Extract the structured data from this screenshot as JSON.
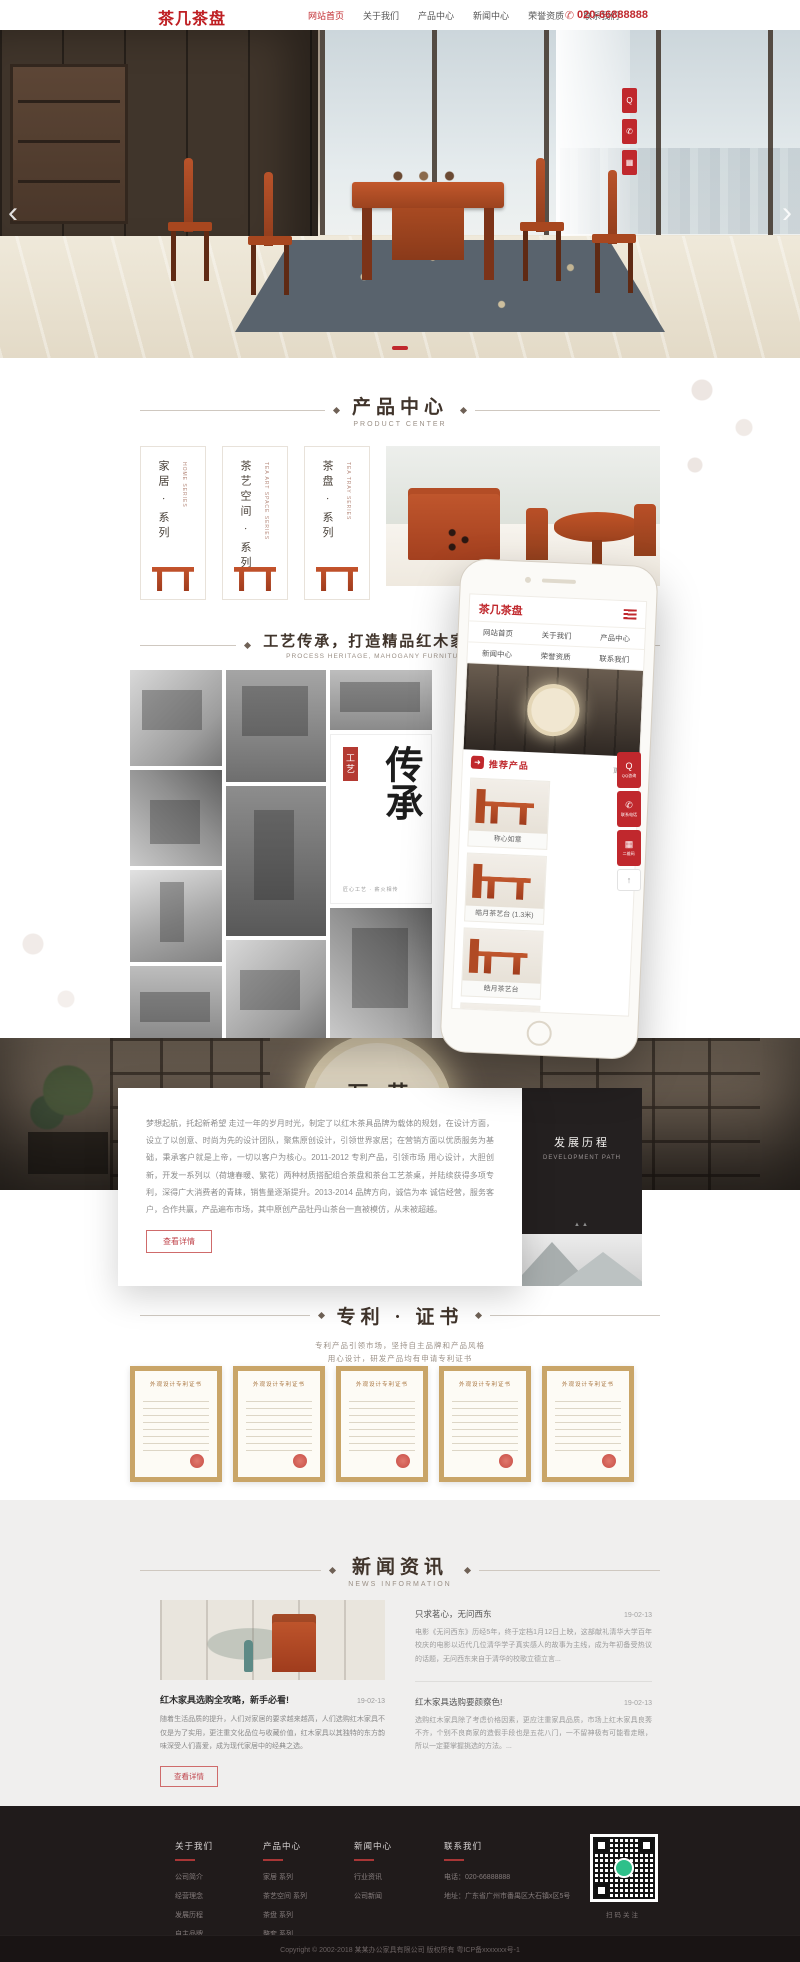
{
  "colors": {
    "accent": "#c0282d",
    "logo_red": "#bf1f23",
    "footer_bg": "#201b1b",
    "news_bg": "#f0efee",
    "title_brown": "#40342b"
  },
  "icons": {
    "prev": "‹",
    "next": "›",
    "phone": "✆",
    "hamburger": "≡",
    "arrow_badge": "➜",
    "qq": "Q",
    "tel": "✆",
    "qr": "▦",
    "up": "↑",
    "chat": "💬"
  },
  "header": {
    "logo": "茶几茶盘",
    "nav": [
      {
        "label": "网站首页"
      },
      {
        "label": "关于我们"
      },
      {
        "label": "产品中心"
      },
      {
        "label": "新闻中心"
      },
      {
        "label": "荣誉资质"
      },
      {
        "label": "联系我们"
      }
    ],
    "phone": "020-66888888"
  },
  "product_center": {
    "title": "产品中心",
    "subtitle": "PRODUCT CENTER",
    "categories": [
      {
        "name": "家居 · 系列",
        "en": "HOME SERIES"
      },
      {
        "name": "茶艺空间 · 系列",
        "en": "TEA ART SPACE SERIES"
      },
      {
        "name": "茶盘 · 系列",
        "en": "TEA TRAY SERIES"
      }
    ]
  },
  "craft": {
    "title": "工艺传承，打造精品红木家具 · 茶具",
    "subtitle": "PROCESS HERITAGE, MAHOGANY FURNITURE, TEA SETS",
    "badge": "工艺",
    "calligraphy": "传承",
    "caption": "匠心工艺 · 薪火相传"
  },
  "phone_mock": {
    "logo": "茶几茶盘",
    "menu": [
      "网站首页",
      "关于我们",
      "产品中心",
      "新闻中心",
      "荣誉资质",
      "联系我们"
    ],
    "section": "推荐产品",
    "more": "更多>",
    "products": [
      "称心如意",
      "皓月茶艺台 (1.3米)",
      "皓月茶艺台",
      "国色天香"
    ]
  },
  "showroom": {
    "sign_right": "艺造",
    "sign_left": "万家"
  },
  "about": {
    "text": "梦想起航，托起新希望 走过一年的岁月时光，制定了以红木茶具品牌为载体的规划，在设计方面，设立了以创意、时尚为先的设计团队，聚焦原创设计，引领世界家居；在营销方面以优质服务为基础，秉承客户就是上帝，一切以客户为核心。2011-2012 专利产品，引领市场 用心设计，大胆创新，开发一系列以（荷塘春暖、繁花）两种材质搭配组合茶盘和茶台工艺茶桌，并陆续获得多项专利，深得广大消费者的青睐，销售量逐渐提升。2013-2014 品牌方向，诚信为本 诚信经营，服务客户，合作共赢，产品遍布市场，其中原创产品牡丹山茶台一直被模仿，从未被超越。",
    "button": "查看详情",
    "panel_title": "发展历程",
    "panel_subtitle": "DEVELOPMENT PATH"
  },
  "patents": {
    "title": "专利 · 证书",
    "desc1": "专利产品引领市场，坚持自主品牌和产品风格",
    "desc2": "用心设计，研发产品均有申请专利证书",
    "cert_title": "外观设计专利证书"
  },
  "news": {
    "title": "新闻资讯",
    "subtitle": "NEWS INFORMATION",
    "featured": {
      "title": "红木家具选购全攻略，新手必看!",
      "date": "19-02-13",
      "text": "随着生活品质的提升，人们对家居的要求越来越高，人们选购红木家具不仅是为了实用，更注重文化品位与收藏价值，红木家具以其独特的东方韵味深受人们喜爱，成为现代家居中的经典之选。",
      "button": "查看详情"
    },
    "items": [
      {
        "title": "只求茗心，无问西东",
        "date": "19-02-13",
        "text": "电影《无问西东》历经5年，终于定档1月12日上映，这部献礼清华大学百年校庆的电影以近代几位清华学子真实感人的故事为主线，成为年初备受热议的话题，无问西东来自于清华的校歌立德立言..."
      },
      {
        "title": "红木家具选购要颜察色!",
        "date": "19-02-13",
        "text": "选购红木家具除了考虑价格因素，更应注重家具品质，市场上红木家具良莠不齐，个别不良商家的造假手段也是五花八门，一不留神极有可能看走眼，所以一定要掌握挑选的方法。..."
      }
    ]
  },
  "floating": [
    {
      "label": "QQ咨询"
    },
    {
      "label": "联系电话"
    },
    {
      "label": "二维码"
    },
    {
      "label": "返回顶部"
    }
  ],
  "footer": {
    "columns": [
      {
        "title": "关于我们",
        "links": [
          "公司简介",
          "经营理念",
          "发展历程",
          "自主品牌"
        ]
      },
      {
        "title": "产品中心",
        "links": [
          "家居 系列",
          "茶艺空间 系列",
          "茶盘 系列",
          "整套 系列"
        ]
      },
      {
        "title": "新闻中心",
        "links": [
          "行业资讯",
          "公司新闻"
        ]
      },
      {
        "title": "联系我们",
        "links": [
          "电话：020-66888888",
          "地址：广东省广州市番禺区大石镇x区5号"
        ]
      }
    ],
    "qr_caption": "扫码关注",
    "copyright": "Copyright © 2002-2018 某某办公家具有限公司 版权所有  粤ICP备xxxxxxx号-1"
  }
}
